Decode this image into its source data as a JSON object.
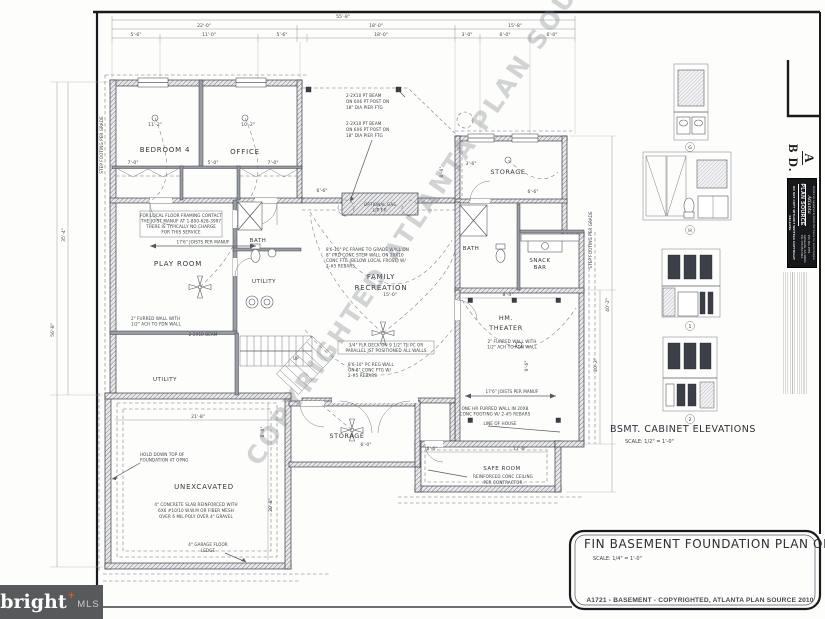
{
  "brand": {
    "name": "bright",
    "mark": "+",
    "sub": "MLS"
  },
  "titles": {
    "plan": "FIN BASEMENT FOUNDATION PLAN OPTION",
    "plan_scale": "SCALE: 1/4\" = 1'-0\"",
    "elev": "BSMT. CABINET ELEVATIONS",
    "elev_scale": "SCALE: 1/2\" = 1'-0\"",
    "footer": "A1721 - BASEMENT - COPYRIGHTED, ATLANTA PLAN SOURCE 2010"
  },
  "watermark": {
    "text": "COPYRIGHTED ATLANTA PLAN SOURCE, INC."
  },
  "side": {
    "logo_a": "A",
    "logo_bd": "B D.",
    "brand_script": "Atlanta",
    "brand_main": "PLAN SOURCE",
    "addr1": "P.O. Box 1553",
    "addr2": "Alpharetta, GA 30023",
    "addr3": "PH: 770-664-6116",
    "notice_top": "All plans are copyrighted by Atlanta Plan Source, Inc. and/or Designer",
    "notice_bottom": "DO NOT COPY WITHOUT WRITTEN COPYRIGHT RELEASE"
  },
  "elev_tags": {
    "g": "G",
    "h": "H",
    "one": "1",
    "two": "2"
  },
  "rooms": {
    "bedroom4": "BEDROOM 4",
    "office": "OFFICE",
    "playroom": "PLAY ROOM",
    "bath1": "BATH",
    "utility1": "UTILITY",
    "utility2": "UTILITY",
    "family1": "FAMILY",
    "family2": "RECREATION",
    "storage_tr": "STORAGE",
    "bath2": "BATH",
    "snack1": "SNACK",
    "snack2": "BAR",
    "theater1": "HM.",
    "theater2": "THEATER",
    "storage_b": "STORAGE",
    "saferoom": "SAFE ROOM",
    "unexcavated": "UNEXCAVATED",
    "up": "UP"
  },
  "notes": {
    "contact": [
      "FOR LOCAL FLOOR FRAMING CONTACT",
      "THE JOIST MANUF AT 1-800-628-3997",
      "THERE IS TYPICALLY NO CHARGE",
      "FOR THIS SERVICE"
    ],
    "joists": "17'6\" JOISTS PER MANUF",
    "beam": [
      "2-2X10 PT BEAM",
      "ON 6X6 PT POST ON",
      "18\" DIA PIER FTG"
    ],
    "gas": [
      "OPTIONAL GAS",
      "L/P F.P."
    ],
    "stem1": [
      "8'6-10\" PC FRAME TO GRADE WALL ON",
      "8\" PRD CONC STEM WALL ON 20X10",
      "CONC FTG (BELOW LOCAL FROST) W/",
      "2-#5 REBARS"
    ],
    "deck": [
      "3/4\" FLR DECK ON 9 1/2\" TJI PC OR",
      "PARALLEL JST POSITIONED ALL WALLS"
    ],
    "stem2": [
      "8'6-10\" PC REG WALL",
      "ON 8\" CONC FTG W/",
      "2-#5 REBARS"
    ],
    "furred": [
      "2\" FURRED WALL WITH",
      "1/2\" ACH TO FDN WALL"
    ],
    "beam2": "2-2X10 BEAM",
    "onehr": [
      "ONE HR FURRED WALL IN 20X8",
      "CONC FOOTING W/ 2-#5 REBARS"
    ],
    "house": "LINE OF HOUSE",
    "hold": [
      "HOLD DOWN TOP OF",
      "FOUNDATION AT OPNG"
    ],
    "slab": [
      "4\" CONCRETE SLAB REINFORCED WITH",
      "6X6 #10/10 W.W.M OR FIBER MESH",
      "OVER 6 MIL POLY OVER 4\" GRAVEL"
    ],
    "ledge": [
      "4\" GARAGE FLOOR",
      "LEDGE"
    ],
    "safec": [
      "REINFORCED CONC CEILING",
      "PER CONTRACTOR"
    ],
    "step": "STEP FOOTING PER GRADE"
  },
  "dims": {
    "top1": "55'-8\"",
    "t2a": "22'-0\"",
    "t2b": "18'-0\"",
    "t2c": "15'-8\"",
    "t3a": "5'-6\"",
    "t3b": "11'-0\"",
    "t3c": "5'-6\"",
    "t3d": "18'-0\"",
    "t3e": "3'-0\"",
    "t3f": "6'-0\"",
    "t3g": "6'-0\"",
    "left_outer": "56'-8\"",
    "left_inner": "35'-4\"",
    "right_outer": "40'-2\"",
    "right_inner": "20'-2\"",
    "bed_w": "11'-2\"",
    "off_w": "10'-2\"",
    "cl1": "7'-0\"",
    "cl2": "5'-0\"",
    "cl3": "7'-0\"",
    "fam_w": "15'-0\"",
    "fam_a": "8'-6\"",
    "fam_b": "6'-6\"",
    "st1": "3'-6\"",
    "st2": "6'-6\"",
    "th_w": "8'-4\"",
    "th_h": "9'-6\"",
    "gar_w": "21'-8\"",
    "gar_h": "20'-8\"",
    "gar_i": "8'-8\"",
    "sf_a": "6'-6\"",
    "sf_b": "17'-8\"",
    "stor_b": "6'-0\""
  }
}
